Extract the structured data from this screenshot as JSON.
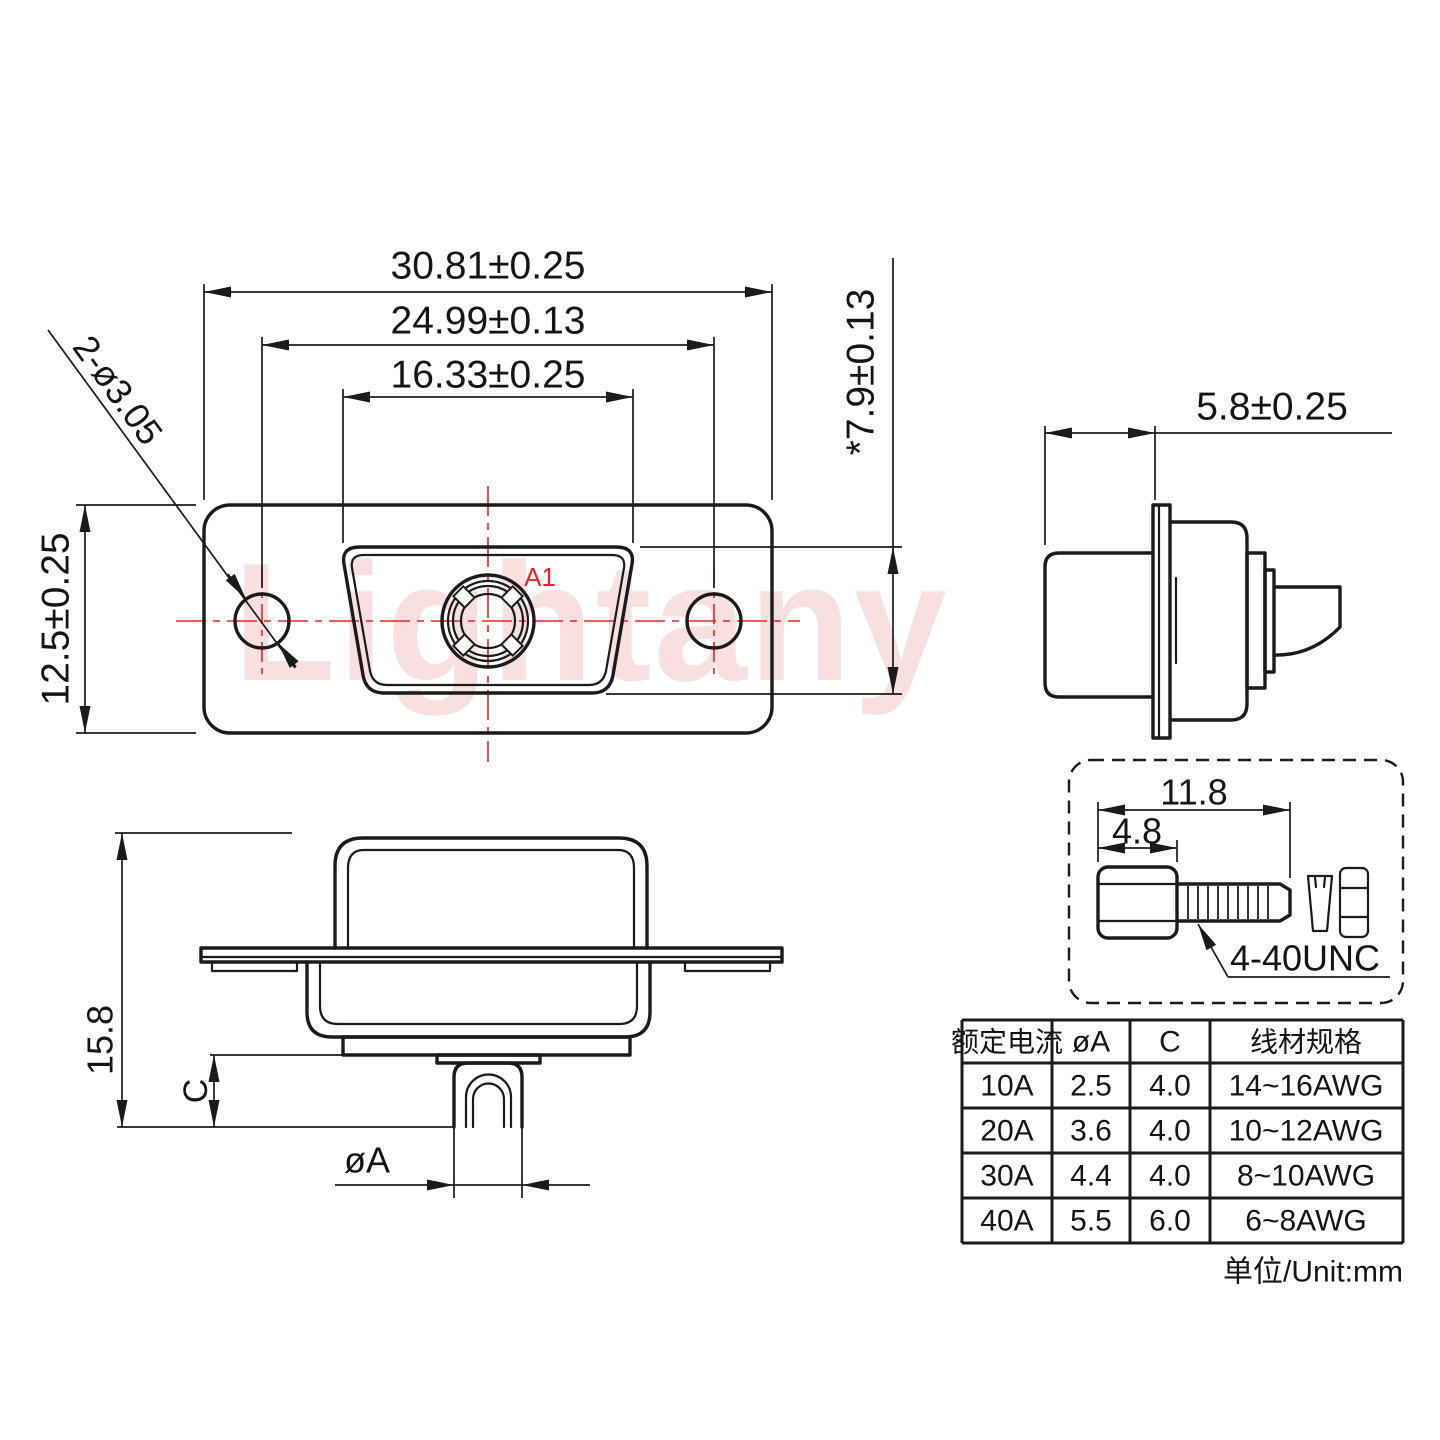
{
  "drawing": {
    "watermark": "Lightany",
    "unit_note": "单位/Unit:mm",
    "front_view": {
      "dim_flange_width": "30.81±0.25",
      "dim_hole_spacing": "24.99±0.13",
      "dim_insert_width": "16.33±0.25",
      "dim_flange_height": "12.5±0.25",
      "dim_insert_height": "*7.9±0.13",
      "dim_mounting_holes": "2-ø3.05",
      "contact_label": "A1"
    },
    "side_view": {
      "dim_depth": "5.8±0.25"
    },
    "bottom_view": {
      "dim_total_height": "15.8",
      "dim_tail_length": "C",
      "dim_tail_diameter": "øA"
    },
    "screw_detail": {
      "dim_total_length": "11.8",
      "dim_head_length": "4.8",
      "thread_label": "4-40UNC"
    },
    "table": {
      "headers": [
        "额定电流",
        "øA",
        "C",
        "线材规格"
      ],
      "rows": [
        [
          "10A",
          "2.5",
          "4.0",
          "14~16AWG"
        ],
        [
          "20A",
          "3.6",
          "4.0",
          "10~12AWG"
        ],
        [
          "30A",
          "4.4",
          "4.0",
          "8~10AWG"
        ],
        [
          "40A",
          "5.5",
          "6.0",
          "6~8AWG"
        ]
      ]
    },
    "colors": {
      "line": "#1b1b1b",
      "accent_red": "#ee2325",
      "watermark_pink": "#e98f8f"
    }
  }
}
